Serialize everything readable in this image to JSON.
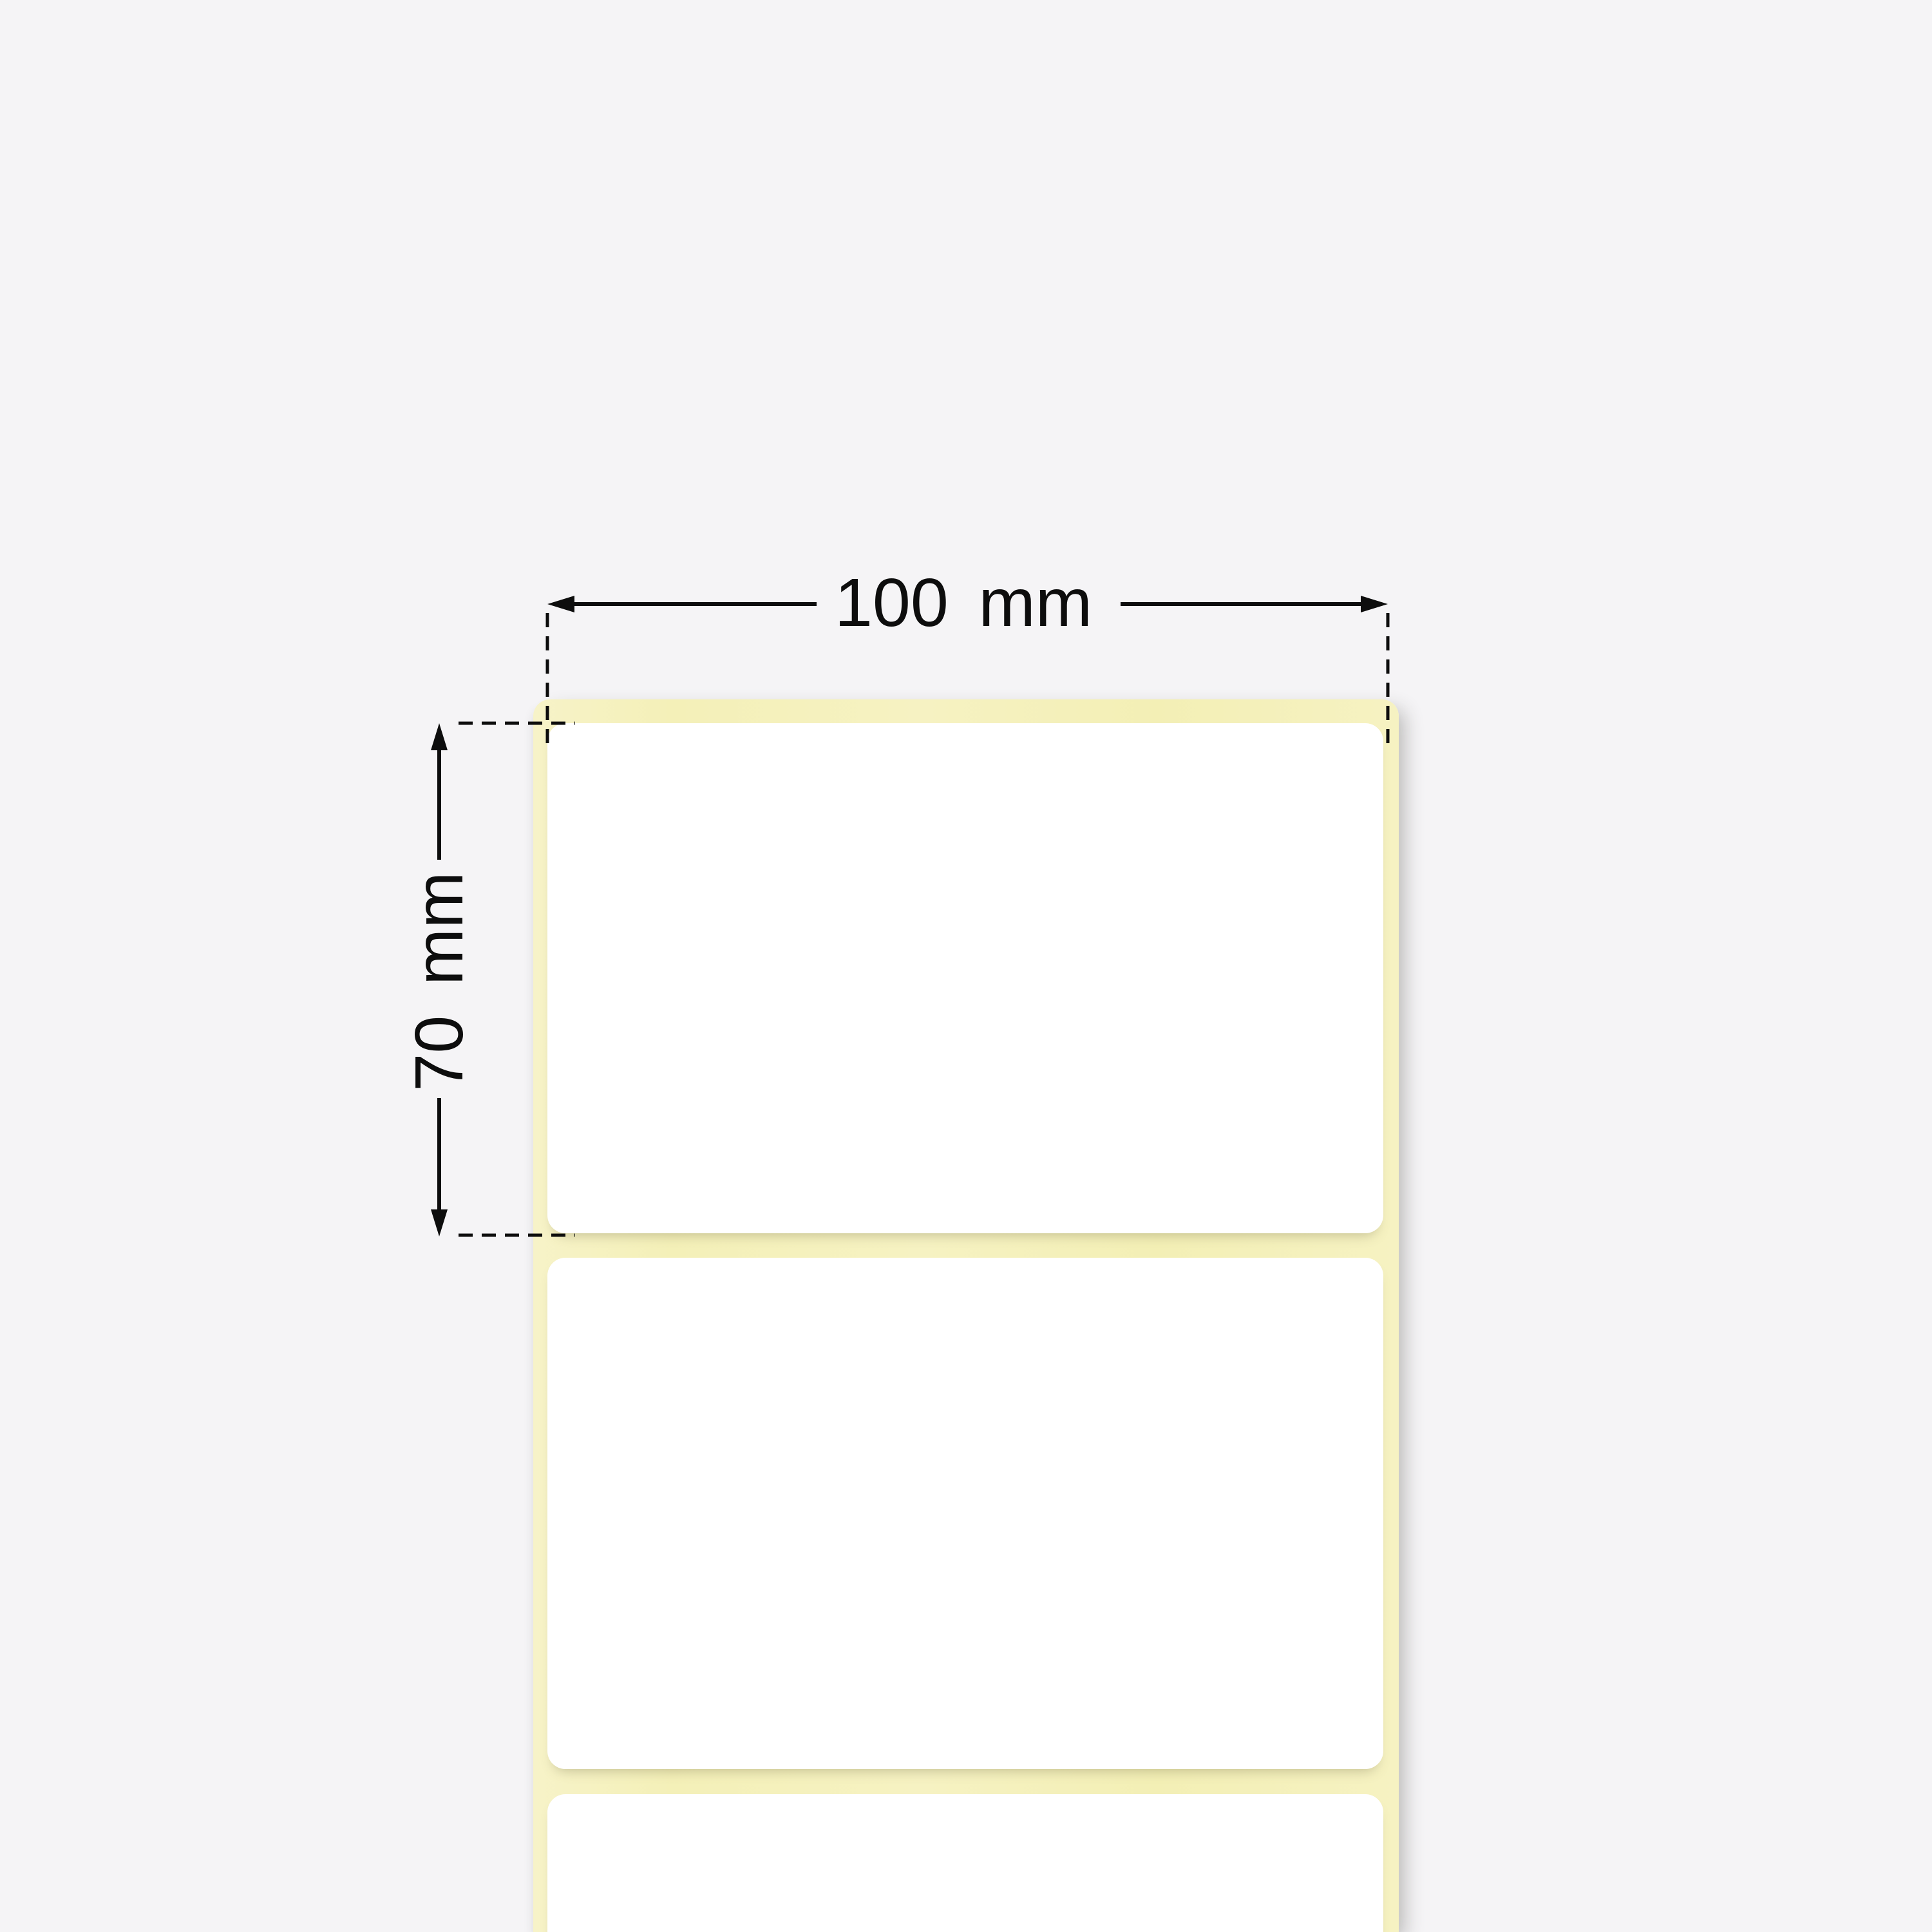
{
  "illustration": {
    "subject": "label-roll-with-dimensions",
    "labels_visible_count": 3
  },
  "dimensions": {
    "width": {
      "value": "100",
      "unit": "mm"
    },
    "height": {
      "value": "70",
      "unit": "mm"
    }
  },
  "colors": {
    "bg": "#f5f4f6",
    "liner": "#f5f1bf",
    "label-face": "#ffffff",
    "annotation": "#0d0d0d"
  }
}
